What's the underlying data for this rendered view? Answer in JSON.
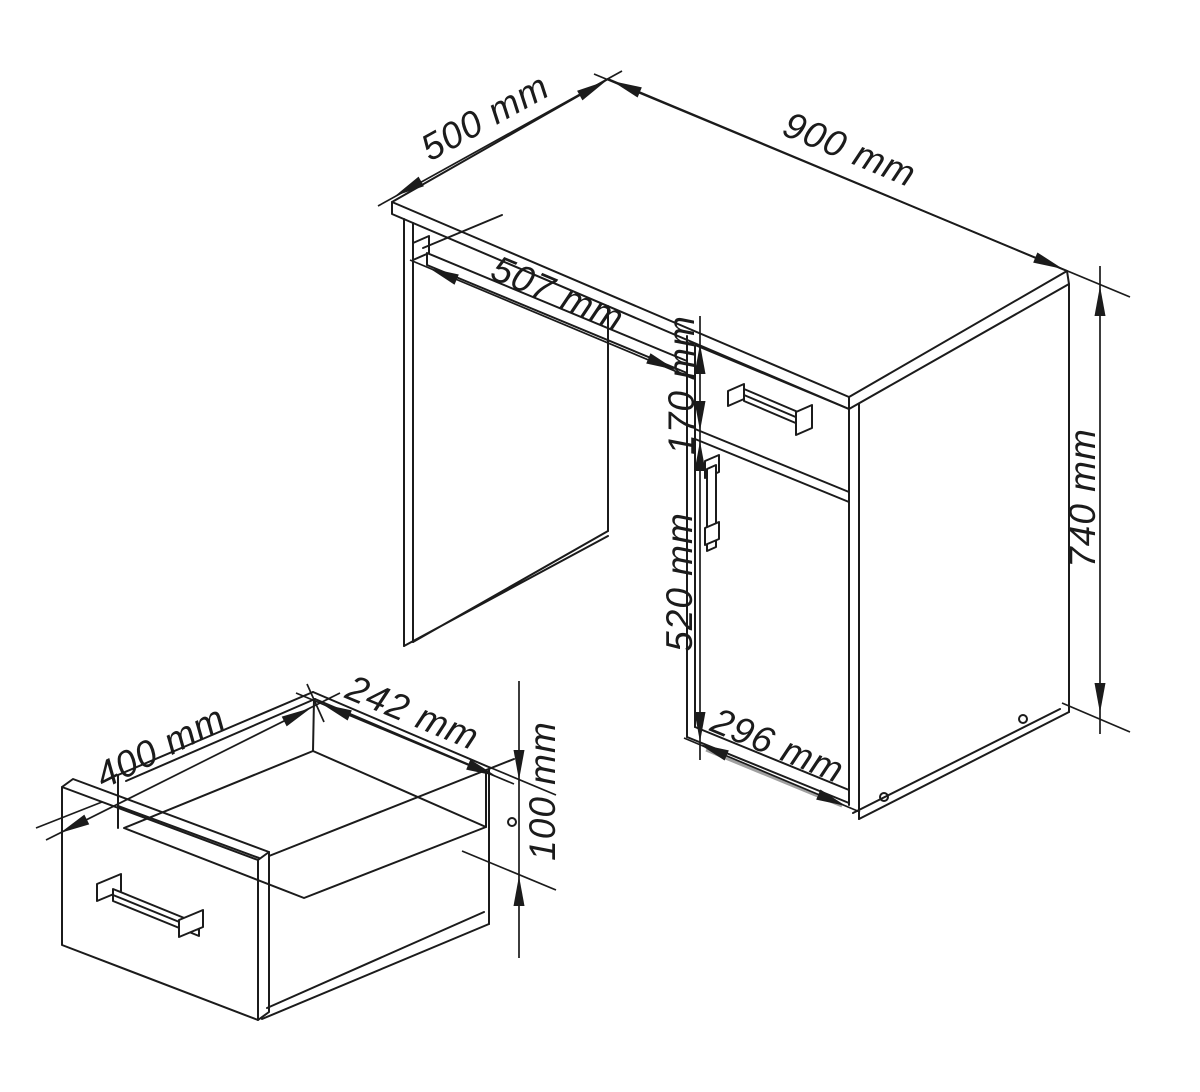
{
  "drawing": {
    "colors": {
      "background": "#ffffff",
      "line": "#1b1b1b",
      "shade": "#a0a0a0"
    },
    "desk": {
      "dims": {
        "depth": "500 mm",
        "width": "900 mm",
        "tray_depth": "507 mm",
        "drawer_front_height": "170 mm",
        "door_height": "520 mm",
        "height": "740 mm",
        "cabinet_width": "296 mm"
      }
    },
    "drawer_detail": {
      "dims": {
        "depth": "400 mm",
        "inner_width": "242 mm",
        "front_height": "100 mm"
      }
    }
  }
}
